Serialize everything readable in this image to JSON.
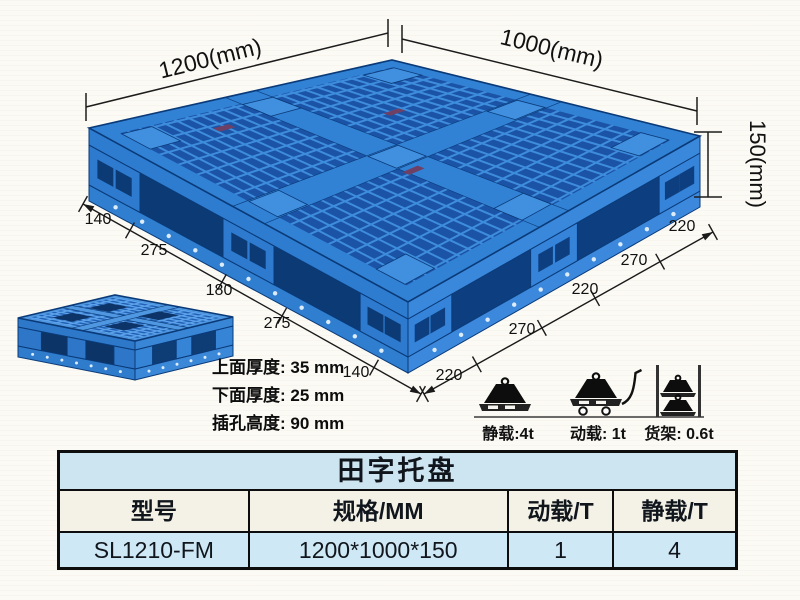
{
  "page": {
    "background": "#fbfaf5"
  },
  "diagram": {
    "dims": {
      "width": "1200(mm)",
      "depth": "1000(mm)",
      "height": "150(mm)"
    },
    "left_chain": [
      "140",
      "275",
      "180",
      "275",
      "140"
    ],
    "right_chain": [
      "220",
      "270",
      "220",
      "270",
      "220"
    ],
    "notes": [
      "上面厚度: 35 mm",
      "下面厚度: 25 mm",
      "插孔高度: 90 mm"
    ],
    "loads": [
      {
        "icon": "static-load-icon",
        "label": "静载:4t"
      },
      {
        "icon": "dynamic-load-icon",
        "label": "动载: 1t"
      },
      {
        "icon": "rack-load-icon",
        "label": "货架: 0.6t"
      }
    ],
    "colors": {
      "pallet_blue": "#2f7fd4",
      "pallet_dark_blue": "#0b3a74",
      "pallet_light_blue": "#4f97e0"
    }
  },
  "table": {
    "title": "田字托盘",
    "headers": [
      "型号",
      "规格/MM",
      "动载/T",
      "静载/T"
    ],
    "rows": [
      [
        "SL1210-FM",
        "1200*1000*150",
        "1",
        "4"
      ]
    ],
    "colors": {
      "title_bg": "#cde4f1",
      "row_bg": "#cfe8f6",
      "border": "#0d0d0d"
    }
  }
}
